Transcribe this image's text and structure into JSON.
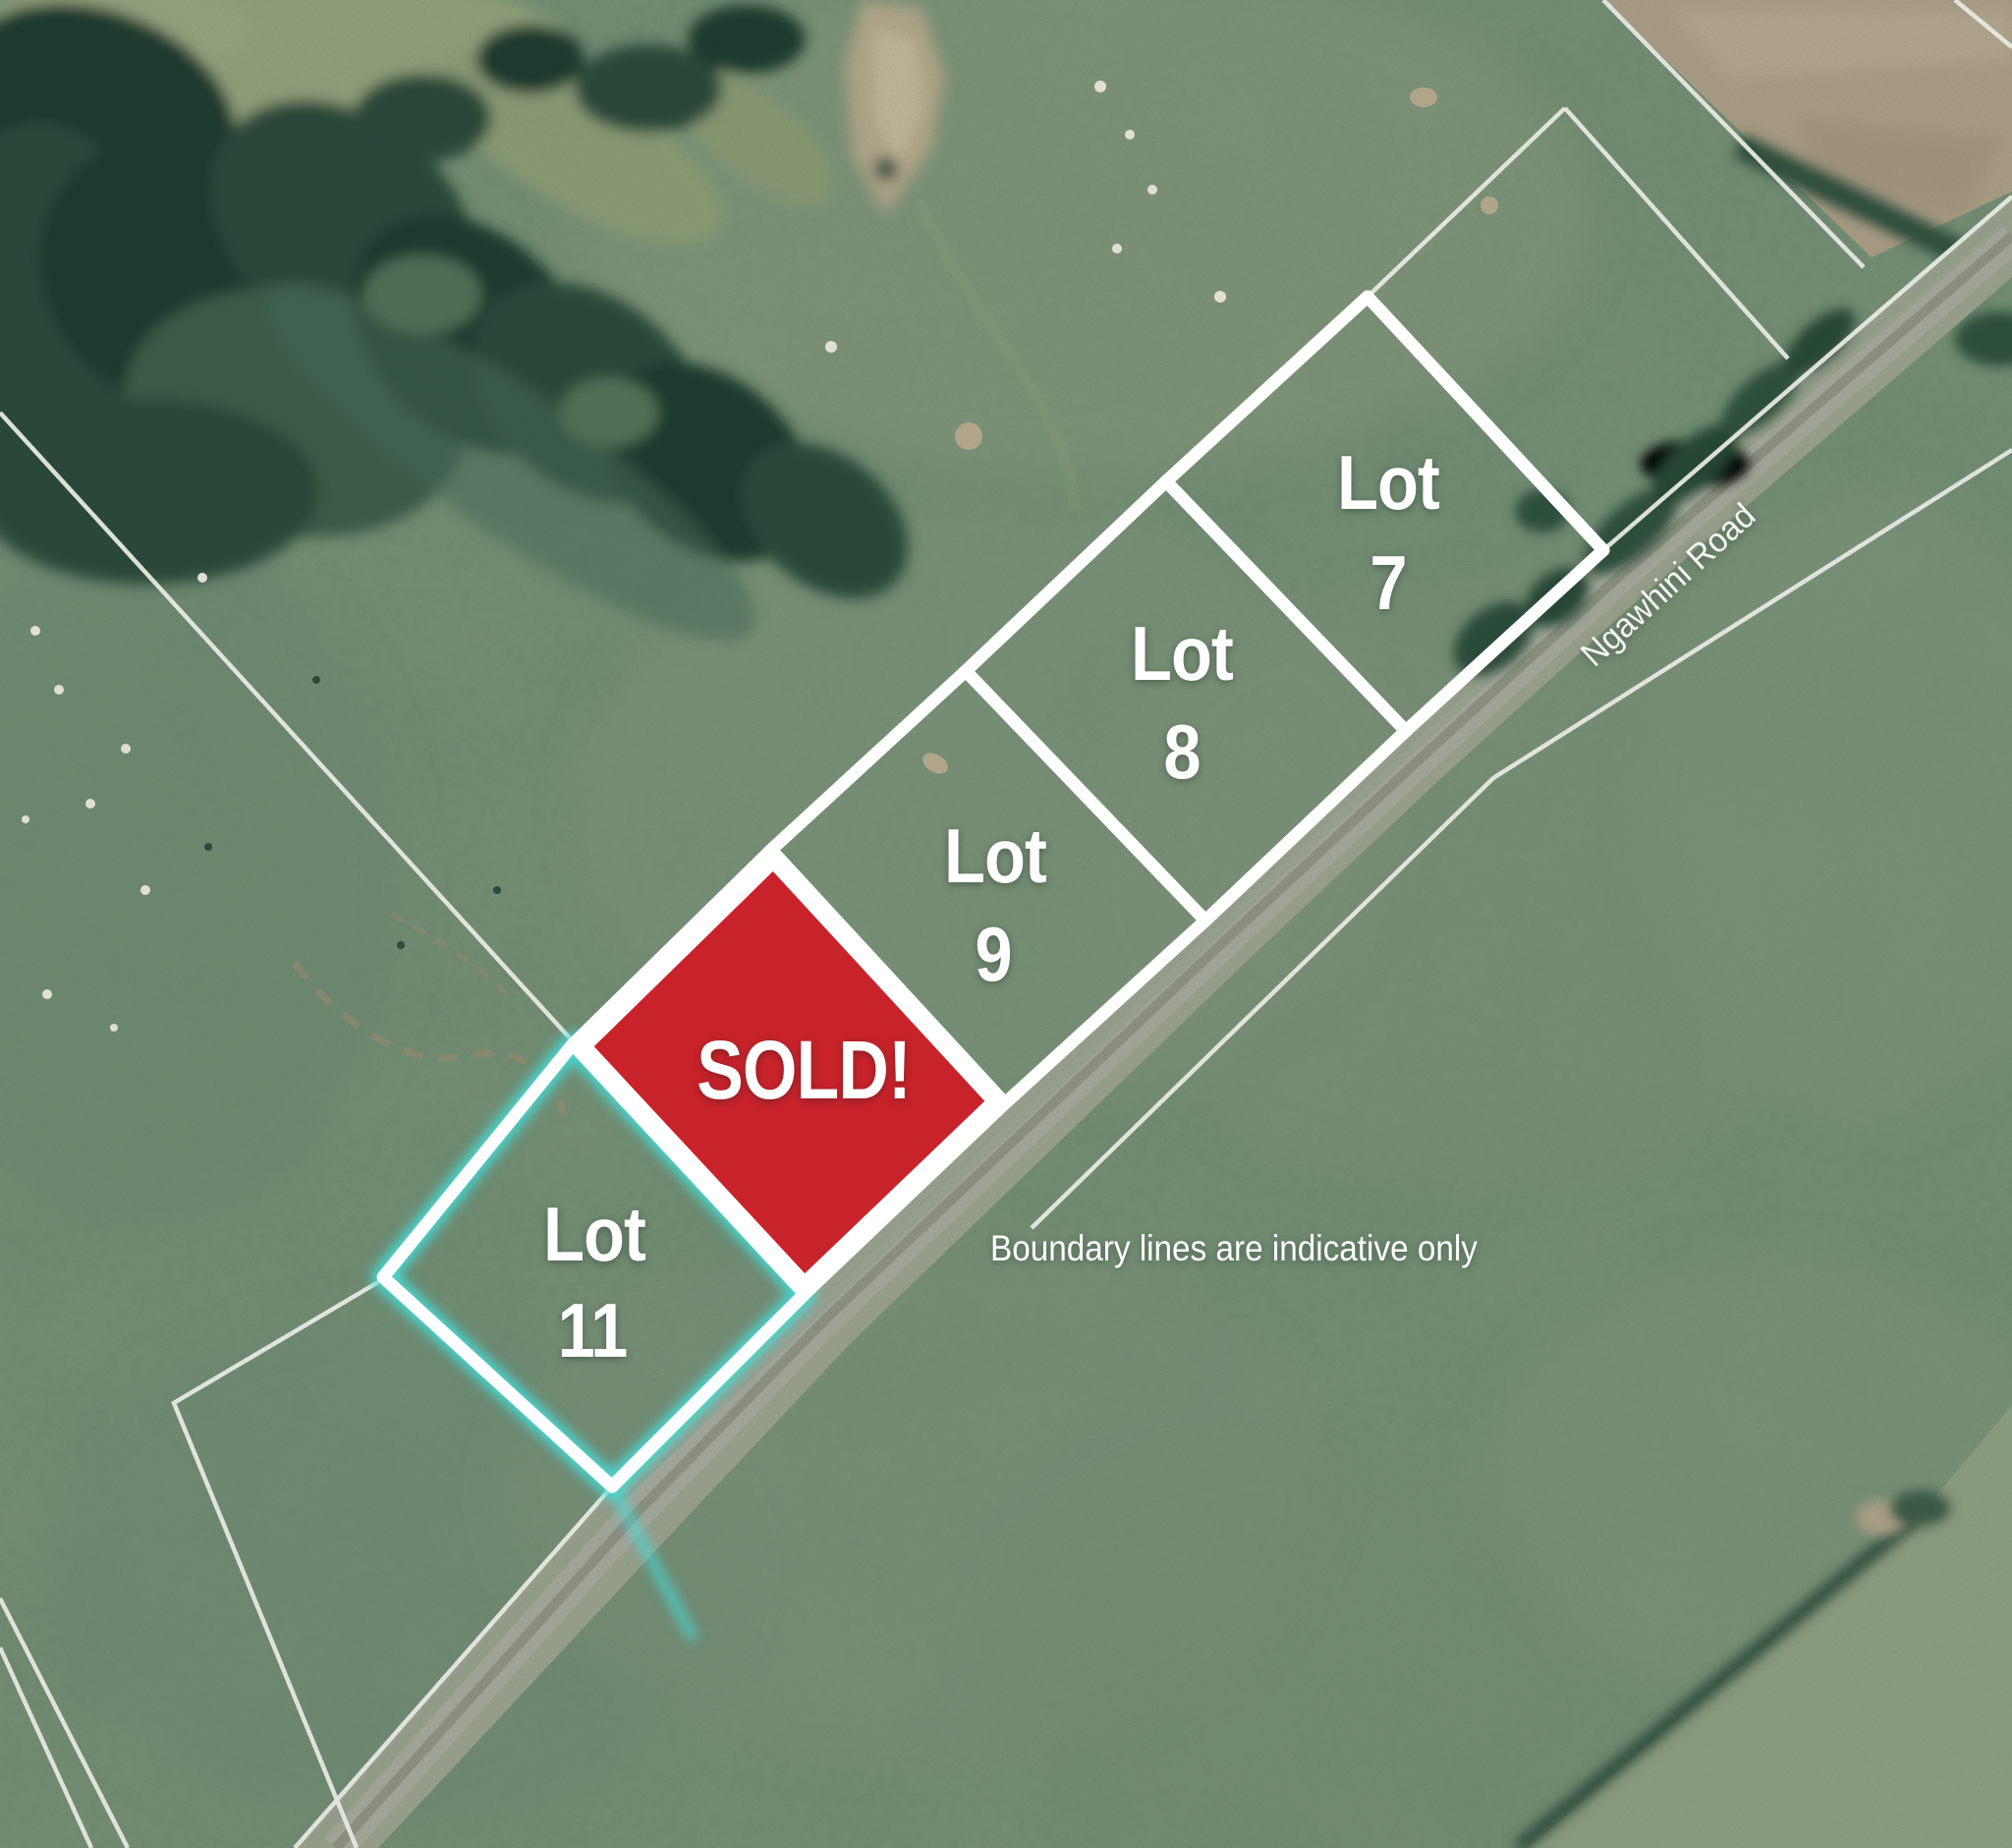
{
  "map": {
    "road_label": "Ngawhini Road",
    "disclaimer": "Boundary lines are indicative only",
    "lot_word": "Lot",
    "lots": [
      {
        "id": "lot-7",
        "number": "7",
        "status": "available"
      },
      {
        "id": "lot-8",
        "number": "8",
        "status": "available"
      },
      {
        "id": "lot-9",
        "number": "9",
        "status": "available"
      },
      {
        "id": "lot-11",
        "number": "11",
        "status": "highlighted"
      }
    ],
    "sold_lot": {
      "label": "SOLD!"
    },
    "colors": {
      "sold_red": "#c8232b",
      "boundary_white": "#ffffff",
      "highlight_cyan": "#3fe3e0",
      "pasture_green": "#779176",
      "road_gray": "#9ca390",
      "bare_field_tan": "#ac9f86",
      "tree_dark": "#2a4a3a"
    }
  }
}
